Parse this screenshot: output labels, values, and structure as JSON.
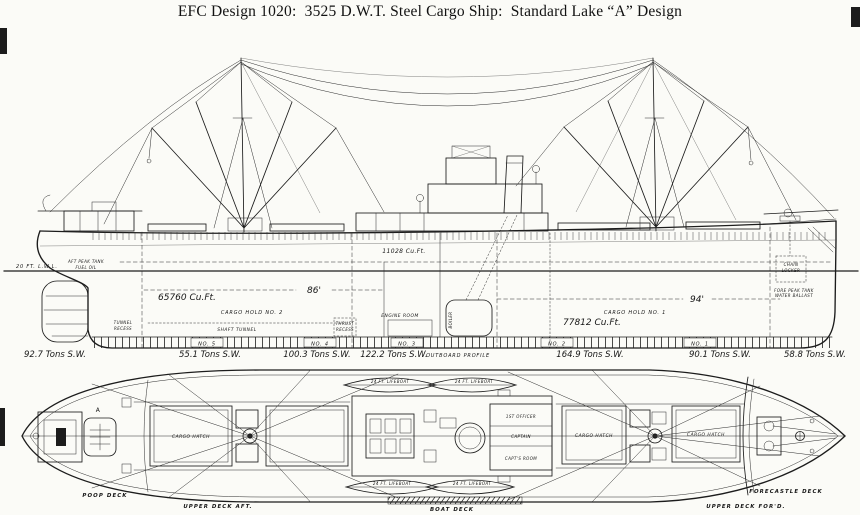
{
  "title": "EFC Design 1020:  3525 D.W.T. Steel Cargo Ship:  Standard Lake “A” Design",
  "colors": {
    "ink": "#1c1c1c",
    "paper": "#fbfbf7"
  },
  "profile": {
    "caption": "OUTBOARD PROFILE",
    "waterline": "20 FT. L.W.L.",
    "aft_peak_line1": "AFT PEAK TANK",
    "aft_peak_line2": "FUEL OIL",
    "tunnel_recess_line1": "TUNNEL",
    "tunnel_recess_line2": "RECESS",
    "shaft_tunnel": "SHAFT TUNNEL",
    "thrust_recess_line1": "THRUST",
    "thrust_recess_line2": "RECESS",
    "engine_room": "ENGINE ROOM",
    "boiler": "BOILER",
    "hold2_volume": "65760 Cu.Ft.",
    "hold2_name": "CARGO HOLD  NO. 2",
    "hold2_length": "86'",
    "deep_tank_volume": "11028 Cu.Ft.",
    "hold1_volume": "77812 Cu.Ft.",
    "hold1_name": "CARGO HOLD  NO. 1",
    "hold1_length": "94'",
    "chain_locker_line1": "CHAIN",
    "chain_locker_line2": "LOCKER",
    "fore_peak_line1": "FORE PEAK TANK",
    "fore_peak_line2": "WATER BALLAST",
    "tanks": [
      "NO. 5",
      "NO. 4",
      "NO. 3",
      "NO. 2",
      "NO. 1"
    ],
    "tonnages": [
      "92.7 Tons S.W.",
      "55.1 Tons S.W.",
      "100.3 Tons S.W.",
      "122.2 Tons S.W.",
      "164.9 Tons S.W.",
      "90.1 Tons S.W.",
      "58.8 Tons S.W."
    ]
  },
  "plan": {
    "poop_deck": "POOP DECK",
    "upper_deck_aft": "UPPER DECK AFT.",
    "boat_deck": "BOAT DECK",
    "upper_deck_ford": "UPPER DECK FOR'D.",
    "forecastle_deck": "FORECASTLE DECK",
    "cargo_hatch": "CARGO HATCH",
    "lifeboat": "24 FT. LIFEBOAT",
    "first_officer": "1ST OFFICER",
    "captain": "CAPTAIN",
    "capts_room": "CAPT'S ROOM",
    "frame_letter": "A"
  }
}
